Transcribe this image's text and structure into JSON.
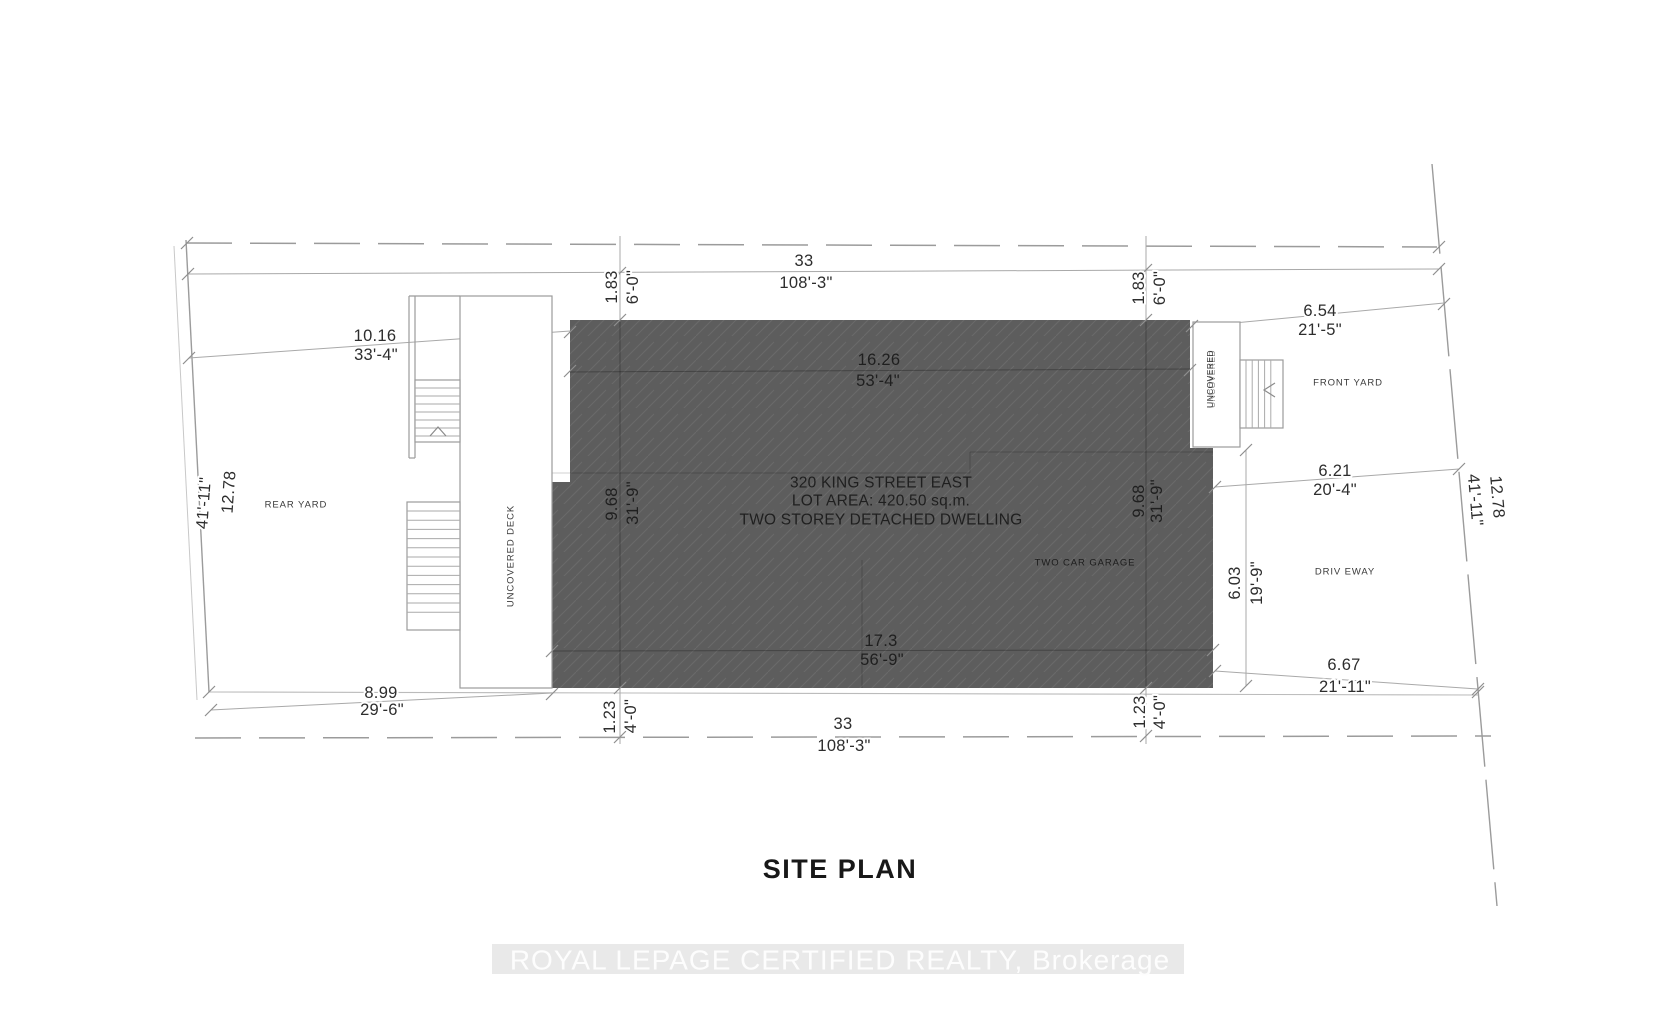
{
  "drawing": {
    "title": "SITE PLAN",
    "watermark": "ROYAL LEPAGE CERTIFIED REALTY, Brokerage"
  },
  "building": {
    "line1": "320 KING STREET EAST",
    "line2": "LOT AREA: 420.50 sq.m.",
    "line3": "TWO STOREY DETACHED DWELLING"
  },
  "labels": {
    "rear_yard": "REAR YARD",
    "front_yard": "FRONT YARD",
    "driveway": "DRIV EWAY",
    "garage": "TWO CAR GARAGE",
    "deck": "UNCOVERED DECK",
    "porch": "UNCOVERED"
  },
  "dimensions": {
    "lot_width_top": {
      "m": "33",
      "ft": "108'-3\""
    },
    "lot_width_bottom": {
      "m": "33",
      "ft": "108'-3\""
    },
    "lot_depth_left": {
      "m": "12.78",
      "ft": "41'-11\""
    },
    "lot_depth_right": {
      "m": "12.78",
      "ft": "41'-11\""
    },
    "house_width_top": {
      "m": "16.26",
      "ft": "53'-4\""
    },
    "house_width_bottom": {
      "m": "17.3",
      "ft": "56'-9\""
    },
    "rear_top": {
      "m": "10.16",
      "ft": "33'-4\""
    },
    "rear_bottom": {
      "m": "8.99",
      "ft": "29'-6\""
    },
    "front_top": {
      "m": "6.54",
      "ft": "21'-5\""
    },
    "front_mid": {
      "m": "6.21",
      "ft": "20'-4\""
    },
    "front_bottom": {
      "m": "6.67",
      "ft": "21'-11\""
    },
    "garage_depth": {
      "m": "6.03",
      "ft": "19'-9\""
    },
    "setback_top_left": {
      "m": "1.83",
      "ft": "6'-0\""
    },
    "setback_top_right": {
      "m": "1.83",
      "ft": "6'-0\""
    },
    "house_depth_left": {
      "m": "9.68",
      "ft": "31'-9\""
    },
    "house_depth_right": {
      "m": "9.68",
      "ft": "31'-9\""
    },
    "setback_bottom_left": {
      "m": "1.23",
      "ft": "4'-0\""
    },
    "setback_bottom_right": {
      "m": "1.23",
      "ft": "4'-0\""
    }
  },
  "colors": {
    "building_fill": "#5d5d5d",
    "hatch": "#6a6a6a",
    "line": "#a9a9a9",
    "boundary": "#9b9b9b",
    "text": "#2d2d2d",
    "watermark_band": "#e9e9e9",
    "watermark_text": "#fdfdfd"
  }
}
